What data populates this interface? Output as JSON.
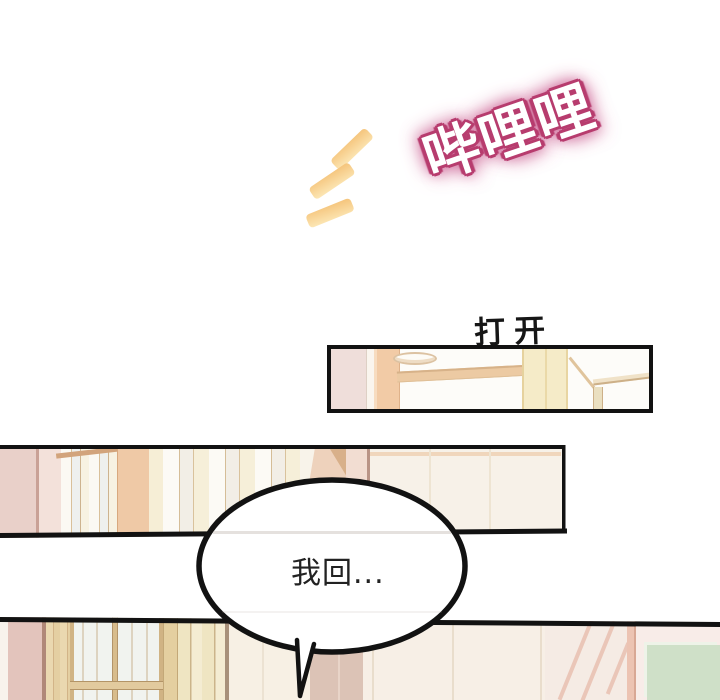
{
  "comic": {
    "sfx_text": "哔哩哩",
    "caption_text": "打开",
    "dialogue_text": "我回...",
    "panels": [
      {
        "id": "ceiling-panel",
        "alt": "ceiling with recessed light, wooden beam and pillars"
      },
      {
        "id": "hallway-panel",
        "alt": "hallway wall with sliding doors and wooden pillars"
      },
      {
        "id": "room-panel",
        "alt": "room entrance with glass-paned wooden door and mint wall panel"
      }
    ]
  },
  "colors": {
    "page_bg": "#ffffff",
    "panel_border": "#121212",
    "sfx_fill": "#ffffff",
    "sfx_outline": "#b73c6e",
    "sfx_glow": "#d06c9c",
    "dash_light": "#fce7b6",
    "dash_dark": "#f5c47b",
    "caption_ink": "#161616",
    "dialogue_ink": "#222222",
    "bubble_fill": "#ffffff"
  }
}
